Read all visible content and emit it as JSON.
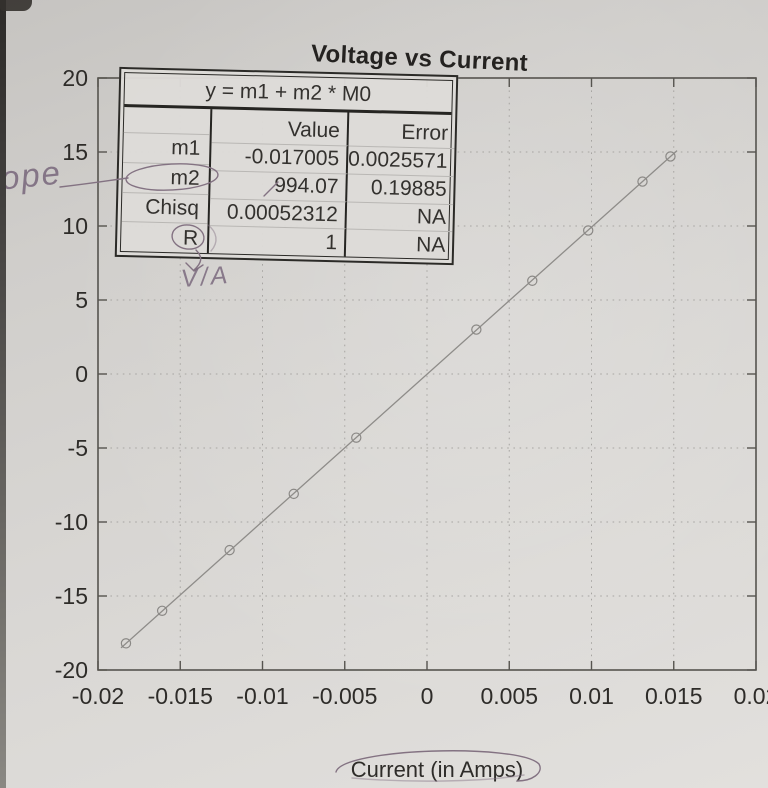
{
  "title": "Voltage vs Current",
  "fit_table": {
    "equation": "y = m1 + m2 * M0",
    "value_header": "Value",
    "error_header": "Error",
    "rows": [
      {
        "label": "m1",
        "value": "-0.017005",
        "error": "0.0025571"
      },
      {
        "label": "m2",
        "value": "994.07",
        "error": "0.19885"
      },
      {
        "label": "Chisq",
        "value": "0.00052312",
        "error": "NA"
      },
      {
        "label": "R",
        "value": "1",
        "error": "NA"
      }
    ]
  },
  "axis": {
    "x_label": "Current (in Amps)"
  },
  "handwritten": {
    "slope_note": "slope",
    "unit_note": "V/A",
    "circled_items": [
      "m2",
      "R",
      "Current (in Amps)"
    ]
  },
  "colors": {
    "paper": "#d6d4d1",
    "ink": "#2e2c29",
    "pencil": "#837282",
    "grid": "#a7a5a2",
    "frame": "#56544f",
    "photo_edge": "#2c2a28"
  },
  "chart_data": {
    "type": "scatter",
    "title": "Voltage vs Current",
    "xlabel": "Current (in Amps)",
    "ylabel": "",
    "xlim": [
      -0.02,
      0.02
    ],
    "ylim": [
      -20,
      20
    ],
    "x_ticks": [
      -0.02,
      -0.015,
      -0.01,
      -0.005,
      0,
      0.005,
      0.01,
      0.015,
      0.02
    ],
    "x_tick_labels": [
      "-0.02",
      "-0.015",
      "-0.01",
      "-0.005",
      "0",
      "0.005",
      "0.01",
      "0.015",
      "0.02"
    ],
    "y_ticks": [
      20,
      15,
      10,
      5,
      0,
      -5,
      -10,
      -15,
      -20
    ],
    "y_tick_labels": [
      "20",
      "15",
      "10",
      "5",
      "0",
      "-5",
      "-10",
      "-15",
      "-20"
    ],
    "grid": "dotted",
    "legend": "none",
    "marker": "open-circle",
    "points": [
      {
        "x": -0.0183,
        "y": -18.2
      },
      {
        "x": -0.0161,
        "y": -16.0
      },
      {
        "x": -0.012,
        "y": -11.9
      },
      {
        "x": -0.0081,
        "y": -8.1
      },
      {
        "x": -0.0043,
        "y": -4.3
      },
      {
        "x": 0.003,
        "y": 3.0
      },
      {
        "x": 0.0064,
        "y": 6.3
      },
      {
        "x": 0.0098,
        "y": 9.7
      },
      {
        "x": 0.0131,
        "y": 13.0
      },
      {
        "x": 0.0148,
        "y": 14.7
      }
    ],
    "fit": {
      "equation": "y = m1 + m2 * M0",
      "m1": -0.017005,
      "m2": 994.07,
      "chisq": 0.00052312,
      "R": 1
    }
  }
}
